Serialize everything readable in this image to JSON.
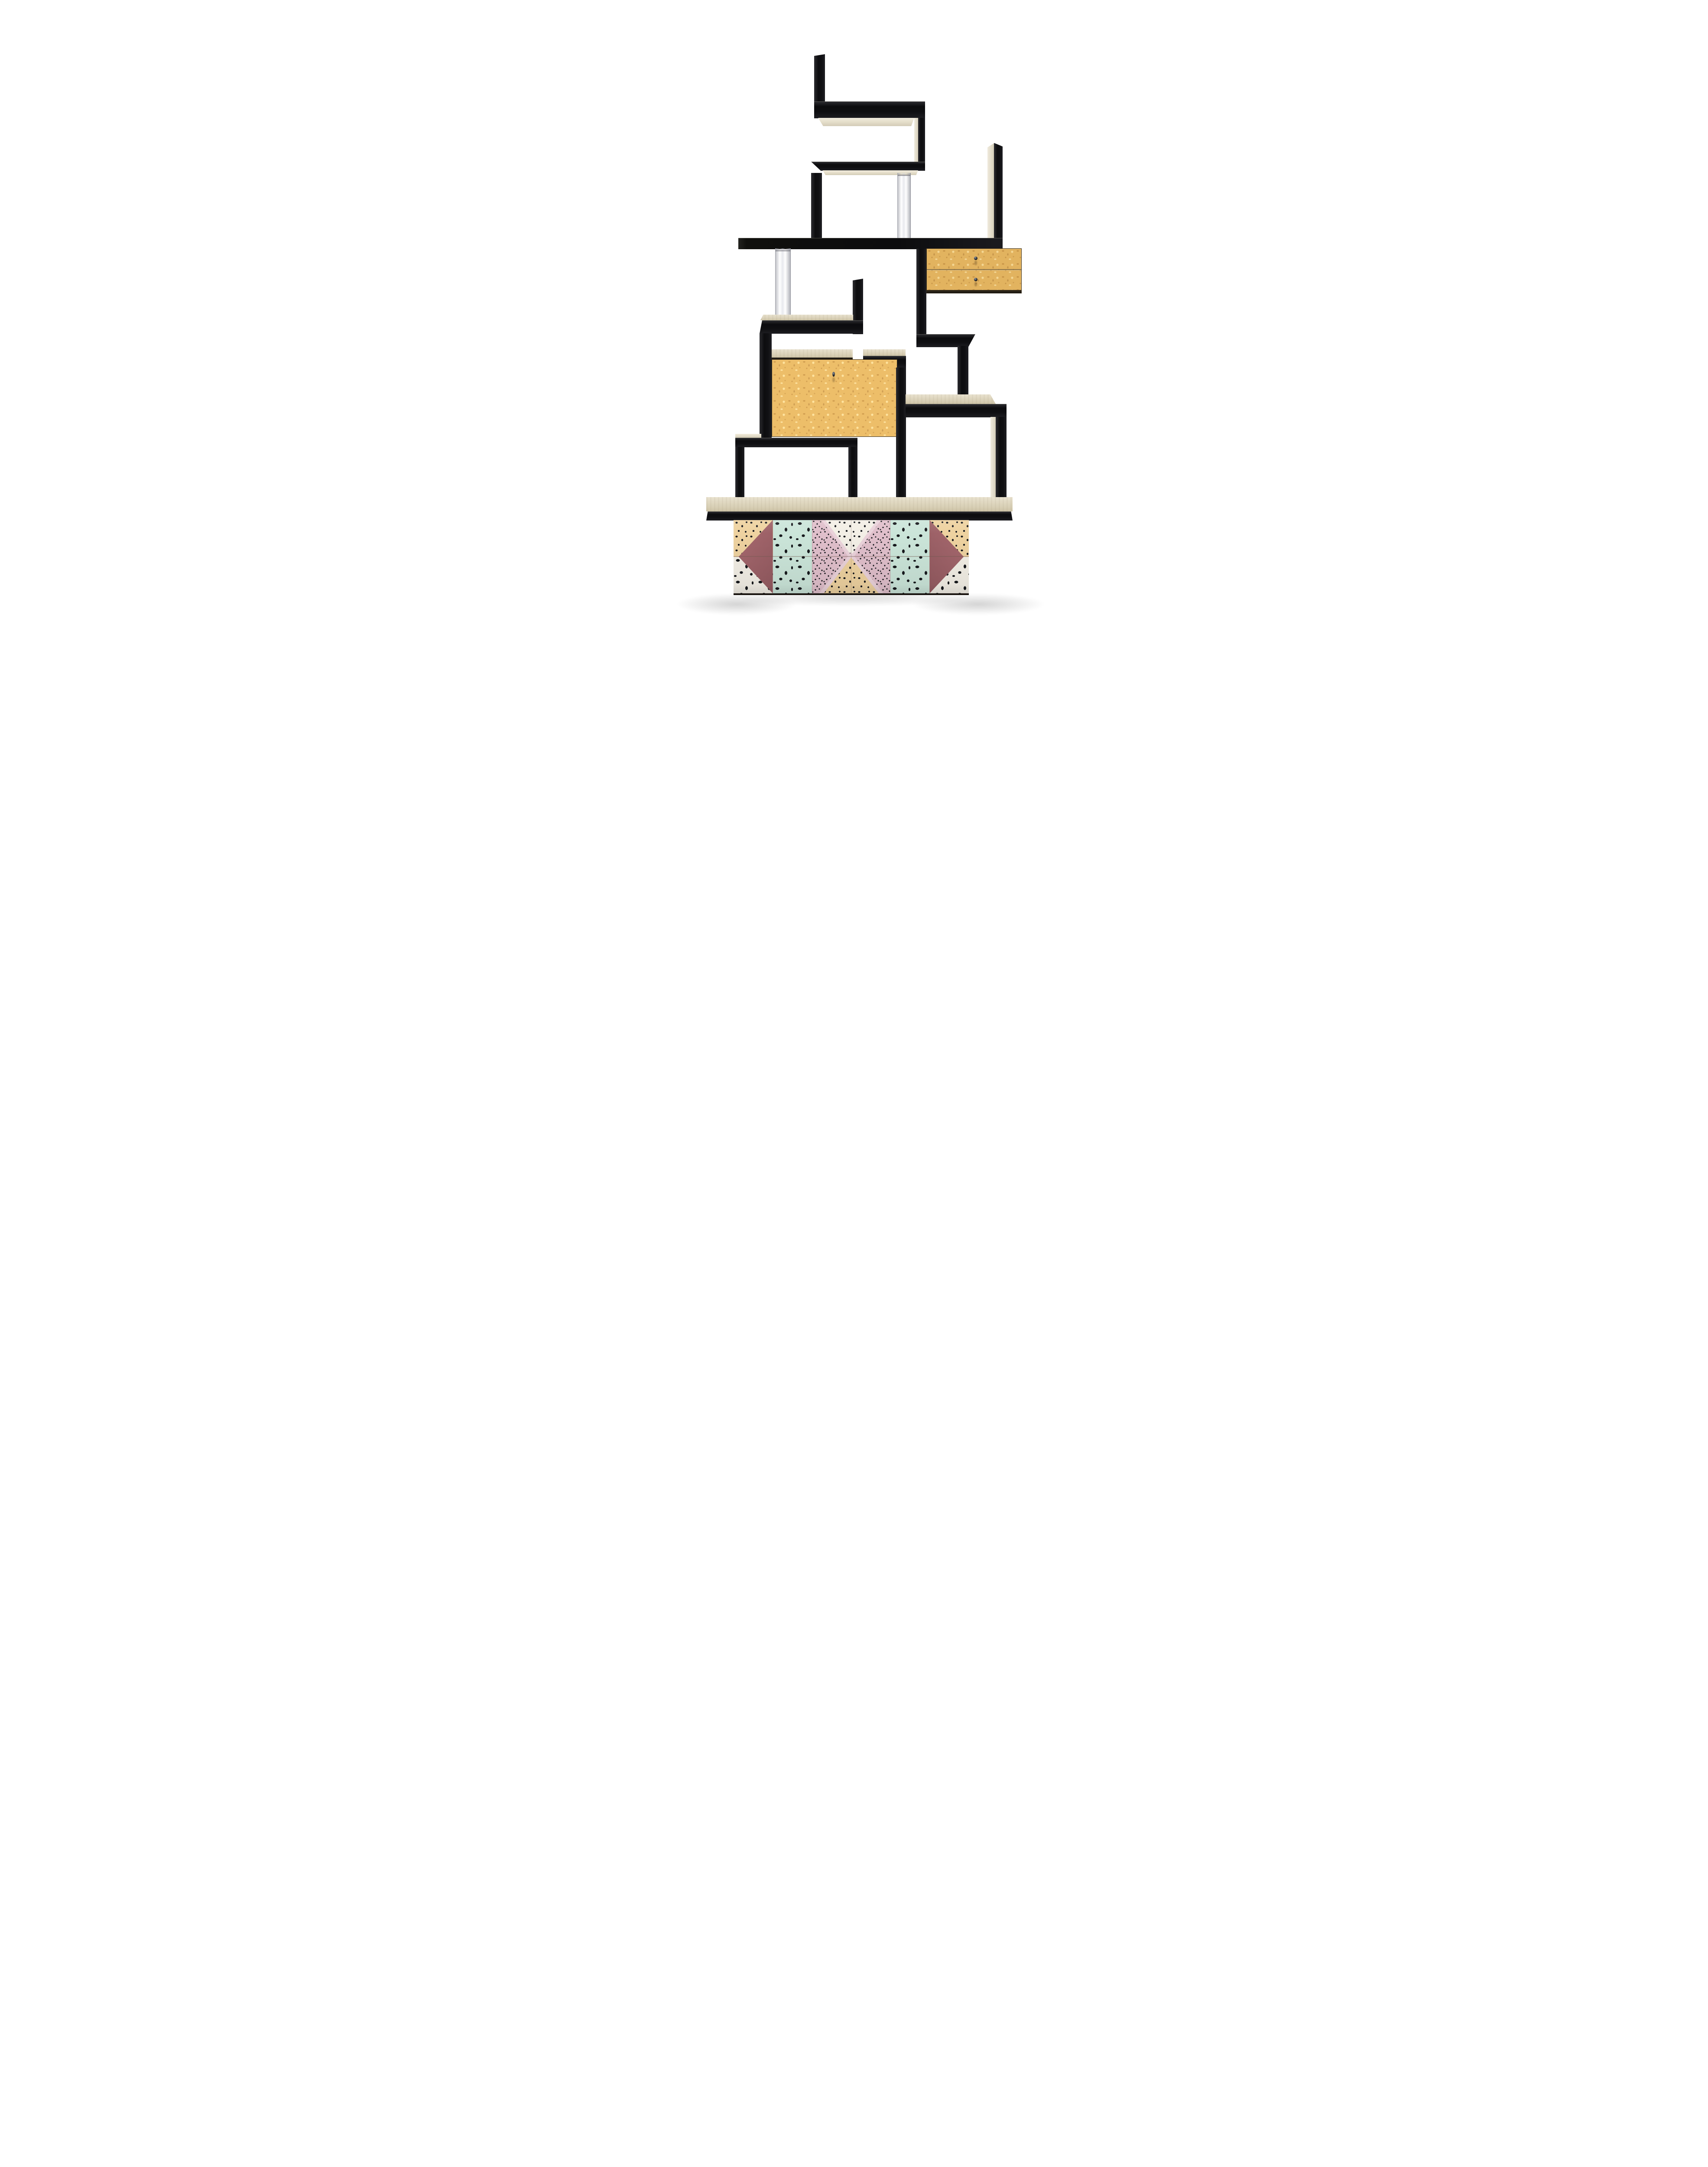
{
  "scene": {
    "type": "studio product photograph",
    "subject": "Postmodern Memphis-style zig-zag room-divider bookcase",
    "background_color": "#ffffff",
    "visible_text": "none"
  },
  "palette": {
    "black-lacquer": "#111114",
    "pale-wood": "#ece6d6",
    "maple": "#e2b35f",
    "maple-dark": "#b9863e",
    "acrylic-gray": "#c9cbd1",
    "tile-mauve": "#a2646a",
    "tile-mint": "#cbe5d9",
    "tile-pink": "#e0bfcb",
    "tile-peach": "#eed2a0",
    "tile-white": "#f3efe6",
    "tile-chip": "#17191d",
    "floor-shadow": "rgba(0,0,0,0.16)"
  },
  "furniture": {
    "structure": "stacked offset zig-zag shelves and open boxes in black lacquered wood with pale whitewashed undersides",
    "components": {
      "black_zigzag_shelves": 4,
      "open_boxes": 3,
      "acrylic_columns": 2,
      "drawer_unit": {
        "drawers": 2,
        "veneer": "bird's-eye maple",
        "knobs": 2,
        "knob_color": "gunmetal black"
      },
      "drop_front_cabinet": {
        "doors": 1,
        "veneer": "bird's-eye maple",
        "keyhole_pulls": 1
      },
      "base_shelf": "long pale-topped shelf with black front edge",
      "plinth": "terrazzo tiled pedestal"
    }
  },
  "plinth": {
    "rows": 2,
    "columns": 6,
    "tiles": [
      {
        "col": 1,
        "top": "peach terrazzo",
        "bottom": "white terrazzo",
        "overlay": "solid mauve triangle pointing left"
      },
      {
        "col": 2,
        "top": "mint terrazzo with large black chips",
        "bottom": "mint terrazzo with large black chips",
        "overlay": "none"
      },
      {
        "col": 3,
        "top": "pink dense terrazzo",
        "bottom": "pink dense terrazzo",
        "overlay": "white triangle pointing down with pale pink border band"
      },
      {
        "col": 4,
        "top": "pink dense terrazzo",
        "bottom": "pink dense terrazzo",
        "overlay": "peach triangle pointing up with pale pink border band"
      },
      {
        "col": 5,
        "top": "mint terrazzo with large black chips",
        "bottom": "mint terrazzo with large black chips",
        "overlay": "none"
      },
      {
        "col": 6,
        "top": "peach terrazzo",
        "bottom": "white terrazzo",
        "overlay": "solid mauve triangle pointing right"
      }
    ]
  },
  "lighting": {
    "key": "soft daylight from upper left",
    "shadows": "soft gray floor shadows flanking plinth base"
  }
}
